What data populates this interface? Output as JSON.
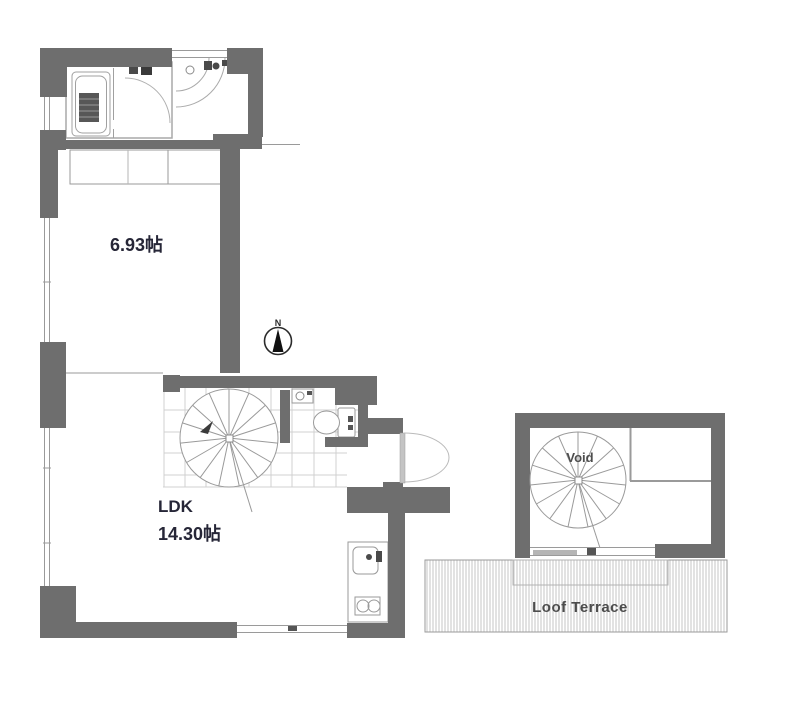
{
  "compass": {
    "north_label": "N"
  },
  "rooms": {
    "bedroom": {
      "area_label": "6.93帖"
    },
    "ldk": {
      "name_label": "LDK",
      "area_label": "14.30帖"
    },
    "void": {
      "label": "Void"
    },
    "terrace": {
      "label": "Loof Terrace"
    }
  },
  "colors": {
    "wall": "#6e6e6e",
    "thin_line": "#9a9a9a",
    "grid_line": "#d0d0d0",
    "room_text": "#262637",
    "annotation_text": "#4d4d4d"
  }
}
